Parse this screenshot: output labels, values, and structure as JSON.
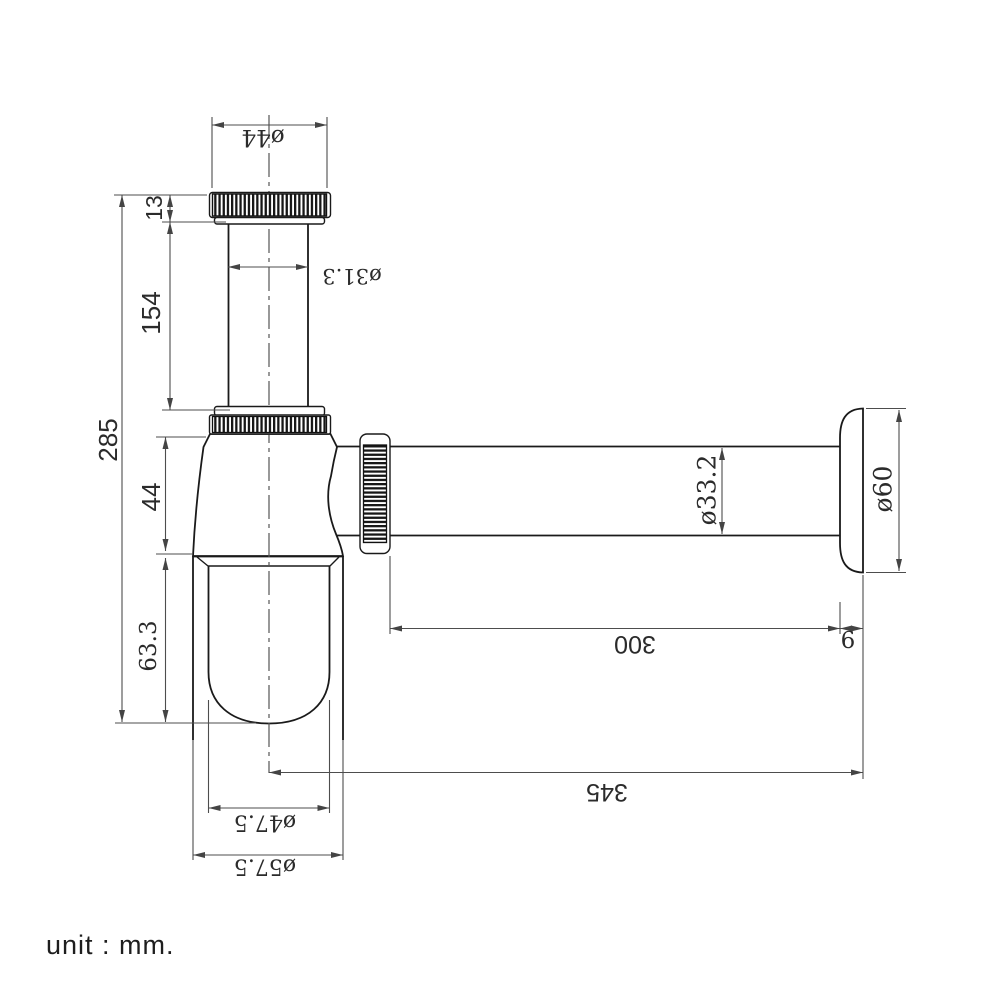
{
  "unit_note": "unit : mm.",
  "drawing": {
    "subject": "bottle trap with wall outlet pipe and flange",
    "dimensions": [
      {
        "id": "cap-diameter",
        "text": "ø44",
        "x": 263,
        "y": 137,
        "rot": 180,
        "font": "serif",
        "size": 23
      },
      {
        "id": "cap-height",
        "text": "13",
        "x": 154,
        "y": 208,
        "rot": -90,
        "font": "sans",
        "size": 23
      },
      {
        "id": "inlet-tube-length",
        "text": "154",
        "x": 151,
        "y": 313,
        "rot": -90,
        "font": "sans",
        "size": 26
      },
      {
        "id": "inlet-tube-diameter",
        "text": "ø31.3",
        "x": 352,
        "y": 276,
        "rot": 180,
        "font": "serif",
        "size": 21
      },
      {
        "id": "total-height",
        "text": "285",
        "x": 108,
        "y": 440,
        "rot": -90,
        "font": "sans",
        "size": 26
      },
      {
        "id": "body-cone-height",
        "text": "44",
        "x": 151,
        "y": 497,
        "rot": -90,
        "font": "sans",
        "size": 26
      },
      {
        "id": "cup-depth",
        "text": "63.3",
        "x": 149,
        "y": 646,
        "rot": -90,
        "font": "serif",
        "size": 23
      },
      {
        "id": "outlet-pipe-diameter",
        "text": "ø33.2",
        "x": 707,
        "y": 490,
        "rot": -90,
        "font": "serif",
        "size": 25
      },
      {
        "id": "flange-diameter",
        "text": "ø60",
        "x": 883,
        "y": 489,
        "rot": -90,
        "font": "serif",
        "size": 25
      },
      {
        "id": "outlet-pipe-length",
        "text": "300",
        "x": 635,
        "y": 644,
        "rot": 180,
        "font": "sans",
        "size": 25
      },
      {
        "id": "flange-thickness",
        "text": "6",
        "x": 848,
        "y": 641,
        "rot": 0,
        "font": "serif",
        "size": 23
      },
      {
        "id": "overall-length",
        "text": "345",
        "x": 607,
        "y": 792,
        "rot": 180,
        "font": "sans",
        "size": 25
      },
      {
        "id": "cup-inner-diameter",
        "text": "ø47.5",
        "x": 265,
        "y": 822,
        "rot": 180,
        "font": "serif",
        "size": 22
      },
      {
        "id": "cup-outer-diameter",
        "text": "ø57.5",
        "x": 265,
        "y": 866,
        "rot": 180,
        "font": "serif",
        "size": 22
      }
    ]
  }
}
